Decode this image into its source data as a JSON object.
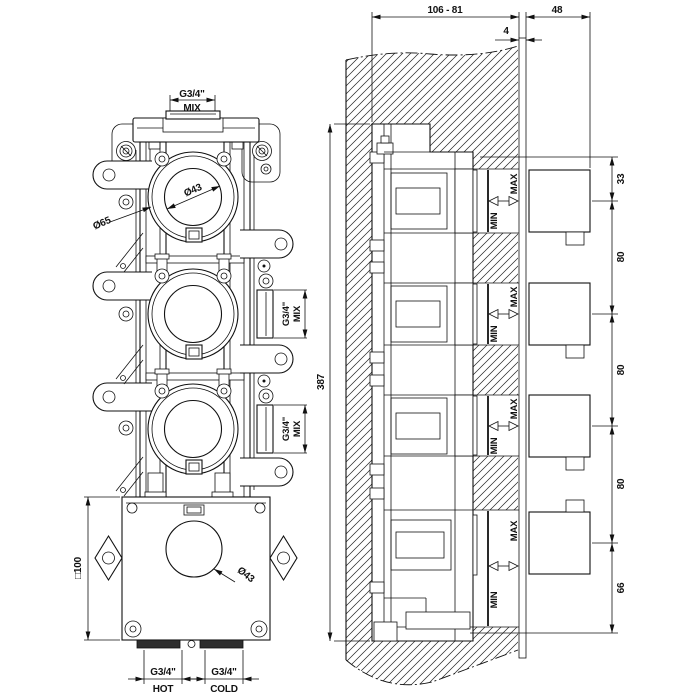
{
  "front_view": {
    "mix_top": {
      "size": "G3/4\"",
      "name": "MIX"
    },
    "dia_outer": "Ø65",
    "dia_inner": "Ø43",
    "mix_side_upper": {
      "size": "G3/4\"",
      "name": "MIX"
    },
    "mix_side_lower": {
      "size": "G3/4\"",
      "name": "MIX"
    },
    "box_square": "□100",
    "box_dia": "Ø43",
    "hot": {
      "size": "G3/4\"",
      "name": "HOT"
    },
    "cold": {
      "size": "G3/4\"",
      "name": "COLD"
    }
  },
  "side_view": {
    "depth_range": "106 - 81",
    "protrusion": "48",
    "plate_thickness": "4",
    "height": "387",
    "top_offset": "33",
    "pitch_1": "80",
    "pitch_2": "80",
    "pitch_3": "80",
    "bottom_offset": "66",
    "min": "MIN",
    "max": "MAX"
  }
}
